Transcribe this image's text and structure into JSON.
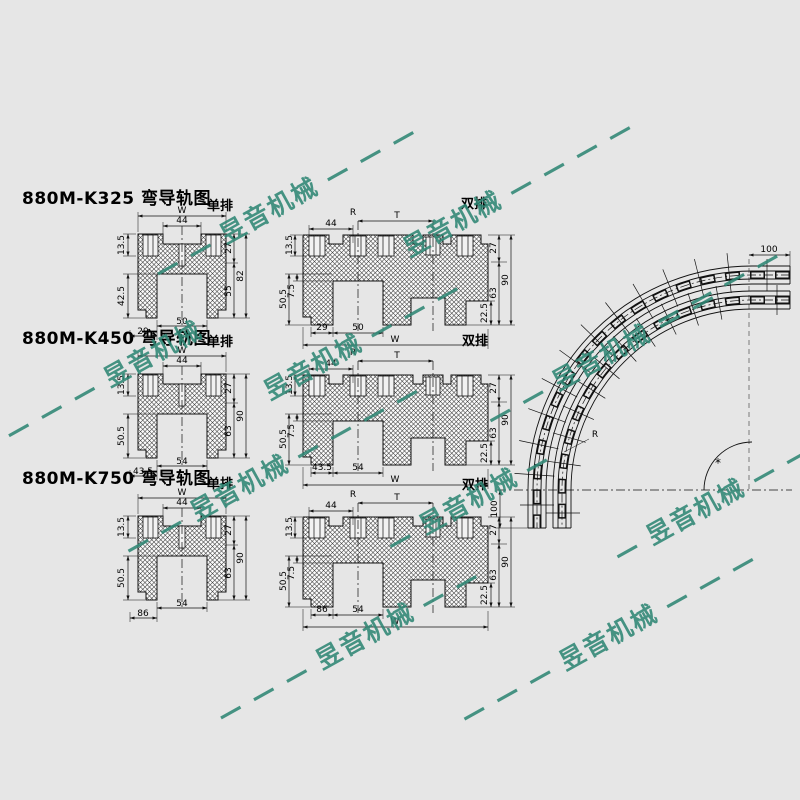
{
  "page": {
    "background": "#e6e6e6",
    "line_color": "#111111",
    "watermark_color": "#2f8674"
  },
  "watermarks": [
    "— — 昱音机械 — — —",
    "昱音机械 — — — —",
    "— — — 昱音机械",
    "昱音机械 — — —",
    "— — 昱音机械 — —",
    "— — 昱音机械 — — — —",
    "— 昱音机械 —",
    "— — — 昱音机械 — —",
    "— — — 昱音机械 — — —",
    "— 昱音机械 — — —",
    "— — — —"
  ],
  "rows": [
    {
      "title": "880M-K325 弯导轨图",
      "single_tag": "单排",
      "double_tag": "双排",
      "single": {
        "w": "W",
        "recess": "44",
        "tab_h": "13.5",
        "leg_h": "42.5",
        "r_top": "27",
        "r_low": "55",
        "r_full": "82",
        "b_left": "29",
        "b_ch": "50"
      },
      "double": {
        "r": "R",
        "t": "T",
        "recess": "44",
        "tab_h": "13.5",
        "leg_h": "50.5",
        "step": "7.5",
        "r_top": "27",
        "r_low": "63",
        "r_full": "90",
        "b_left": "29",
        "b_ch": "50",
        "w": "W",
        "corner": "22.5"
      }
    },
    {
      "title": "880M-K450 弯导轨图",
      "single_tag": "单排",
      "double_tag": "双排",
      "single": {
        "w": "W",
        "recess": "44",
        "tab_h": "13.5",
        "leg_h": "50.5",
        "r_top": "27",
        "r_low": "63",
        "r_full": "90",
        "b_left": "43.5",
        "b_ch": "54"
      },
      "double": {
        "r": "R",
        "t": "T",
        "recess": "44",
        "tab_h": "13.5",
        "leg_h": "50.5",
        "step": "7.5",
        "r_top": "27",
        "r_low": "63",
        "r_full": "90",
        "b_left": "43.5",
        "b_ch": "54",
        "w": "W",
        "corner": "22.5"
      }
    },
    {
      "title": "880M-K750 弯导轨图",
      "single_tag": "单排",
      "double_tag": "双排",
      "single": {
        "w": "W",
        "recess": "44",
        "tab_h": "13.5",
        "leg_h": "50.5",
        "r_top": "27",
        "r_low": "63",
        "r_full": "90",
        "b_left": "86",
        "b_ch": "54"
      },
      "double": {
        "r": "R",
        "t": "T",
        "recess": "44",
        "tab_h": "13.5",
        "leg_h": "50.5",
        "step": "7.5",
        "r_top": "27",
        "r_low": "63",
        "r_full": "90",
        "b_left": "86",
        "b_ch": "54",
        "w": "W",
        "corner": "22.5"
      }
    }
  ],
  "curve": {
    "top_dim": "100",
    "side_dim": "100",
    "r_label": "R",
    "angle_mark": "*"
  }
}
